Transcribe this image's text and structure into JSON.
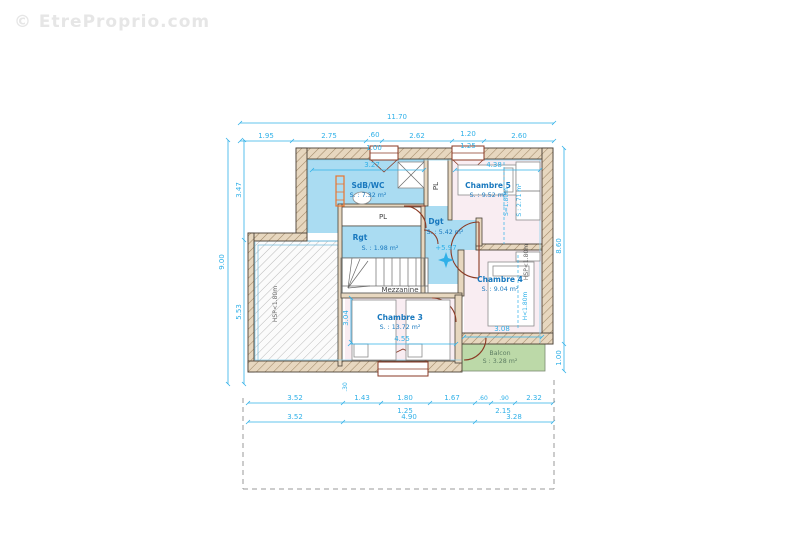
{
  "watermark": "© EtreProprio.com",
  "rooms": {
    "sdb": {
      "name": "SdB/WC",
      "area": "S. : 7.32 m²"
    },
    "ch5": {
      "name": "Chambre 5",
      "area": "S. : 9.52 m²"
    },
    "rgt": {
      "name": "Rgt",
      "area": "S. : 1.98 m²"
    },
    "dgt": {
      "name": "Dgt",
      "area": "S. : 5.42 m²"
    },
    "ch4": {
      "name": "Chambre 4",
      "area": "S. : 9.04 m²"
    },
    "ch3": {
      "name": "Chambre 3",
      "area": "S. : 13.72 m²"
    },
    "balcon": {
      "name": "Balcon",
      "area": "S : 3.28 m²"
    },
    "mezzanine": {
      "name": "Mezzanine"
    },
    "pl_closet": {
      "name": "PL"
    },
    "pl_strip": {
      "name": "PL"
    }
  },
  "annotations": {
    "level": "+5.97",
    "hsp_left": "HSP<1.80m",
    "hsp_right": "HSP<1.80m",
    "h_ch4": "H<1.80m",
    "s180": "S=1.80m",
    "s271": "S : 2.71 m²"
  },
  "dims": {
    "top": {
      "total": "11.70",
      "segs": [
        "1.95",
        "2.75",
        ".60",
        "2.62",
        "1.20",
        "2.60"
      ],
      "subs": [
        "1.00",
        "1.25"
      ]
    },
    "left": {
      "total": "9.00",
      "segs": [
        "3.47",
        "5.53"
      ]
    },
    "right": {
      "segs": [
        "8.60",
        "1.00"
      ]
    },
    "bottom": {
      "row1": [
        "3.52",
        "1.43",
        "1.80",
        "1.67",
        ".60",
        ".90",
        "2.32"
      ],
      "subs": [
        "1.25",
        "2.15"
      ],
      "row2": [
        "3.52",
        "4.90",
        "3.28"
      ]
    },
    "inner": {
      "sdb_w": "3.27",
      "ch5_w": "4.38",
      "ch4_w": "3.08",
      "ch3_w": "4.55",
      "ch3_h": "3.04",
      "wall": ".30"
    }
  },
  "colors": {
    "dim_cyan": "#2fb0e8",
    "label_blue": "#1878be",
    "wet_room_blue": "#aadcf2",
    "bedroom_pink": "#f9edf2",
    "balcony_green": "#bcd9a8",
    "wall_tan": "#e7d7bf",
    "door_brown": "#8a3a24",
    "radiator_orange": "#e87430"
  }
}
